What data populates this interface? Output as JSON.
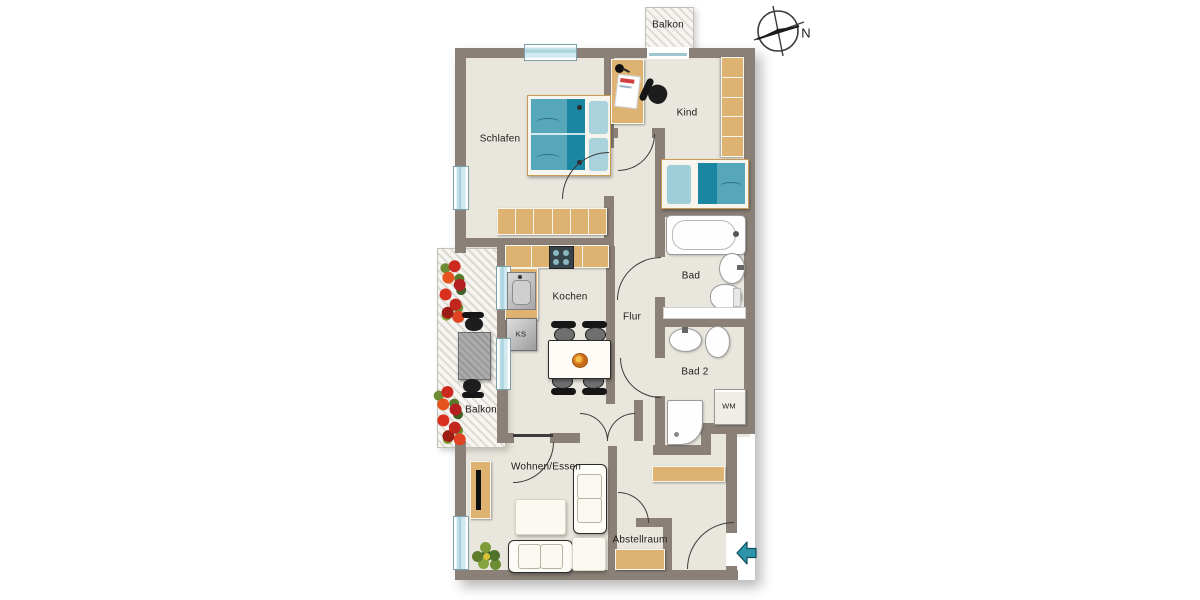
{
  "labels": {
    "balkon_top": "Balkon",
    "schlafen": "Schlafen",
    "kind": "Kind",
    "bad": "Bad",
    "flur": "Flur",
    "kochen": "Kochen",
    "ks": "KS",
    "bad2": "Bad 2",
    "wm": "WM",
    "balkon_left": "Balkon",
    "wohnen_essen": "Wohnen/Essen",
    "abstellraum": "Abstellraum",
    "compass_n": "N"
  },
  "colors": {
    "wall": "#8a8077",
    "floor": "#e9e6dd",
    "furniture_wood": "#deb271",
    "bed_teal": "#57a7ba",
    "bed_teal_dark": "#1b86a1",
    "window_blue": "#cfe9f0",
    "entry_arrow": "#2e94a9"
  },
  "icons": {
    "compass": "compass-rose-icon",
    "entry_arrow": "entry-direction-arrow-left-icon",
    "flowers": "flower-box-icon",
    "plant": "potted-plant-icon"
  }
}
